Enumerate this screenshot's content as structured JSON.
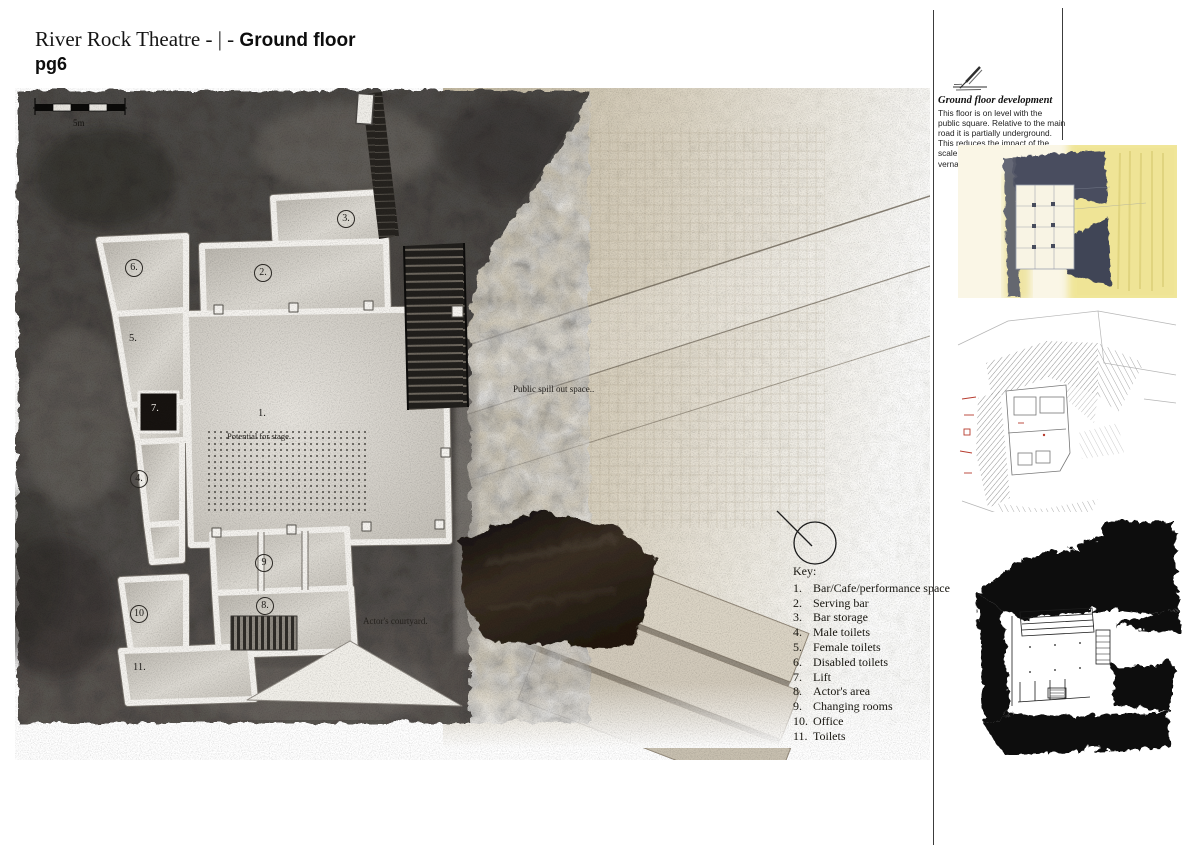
{
  "header": {
    "title_prefix": "River Rock Theatre - | - ",
    "title_emphasis": "Ground floor",
    "page_number": "pg6"
  },
  "plan": {
    "scale_label": "5m",
    "annotations": {
      "stage": "Potential for stage.",
      "public_space": "Public spill out space..",
      "courtyard": "Actor's courtyard."
    },
    "markers": [
      {
        "num": "1."
      },
      {
        "num": "2."
      },
      {
        "num": "3."
      },
      {
        "num": "4."
      },
      {
        "num": "5."
      },
      {
        "num": "6."
      },
      {
        "num": "7."
      },
      {
        "num": "8."
      },
      {
        "num": "9"
      },
      {
        "num": "10"
      },
      {
        "num": "11."
      }
    ],
    "key": {
      "heading": "Key:",
      "items": [
        {
          "num": "1.",
          "label": "Bar/Cafe/performance space"
        },
        {
          "num": "2.",
          "label": "Serving bar"
        },
        {
          "num": "3.",
          "label": "Bar storage"
        },
        {
          "num": "4.",
          "label": "Male toilets"
        },
        {
          "num": "5.",
          "label": "Female toilets"
        },
        {
          "num": "6.",
          "label": "Disabled toilets"
        },
        {
          "num": "7.",
          "label": "Lift"
        },
        {
          "num": "8.",
          "label": "Actor's area"
        },
        {
          "num": "9.",
          "label": "Changing rooms"
        },
        {
          "num": "10.",
          "label": "Office"
        },
        {
          "num": "11.",
          "label": "Toilets"
        }
      ]
    }
  },
  "sidebar": {
    "heading": "Ground floor development",
    "body": "This floor is on level with the public square. Relative to the main road it is partially underground. This reduces the impact of the scale of the building on the local vernacular."
  },
  "colors": {
    "paving": "#d8cfbc",
    "rock": "#44403d",
    "gloss_rock": "#1c140d",
    "sketch_yellow": "#eee289",
    "ink": "#0a0a0a"
  }
}
